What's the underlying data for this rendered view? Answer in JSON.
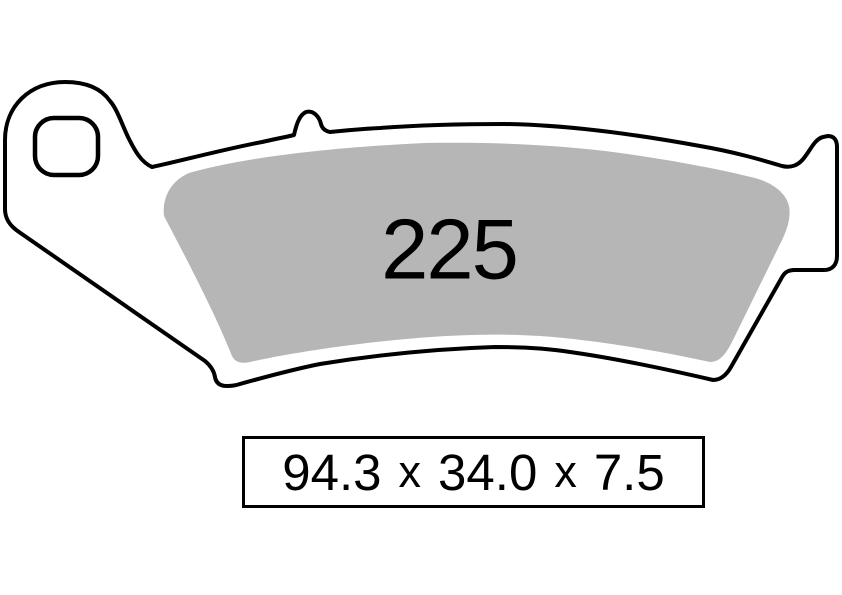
{
  "part_number": "225",
  "dimensions": {
    "parts": [
      "94.3",
      "x",
      "34.0",
      "x",
      "7.5"
    ]
  },
  "colors": {
    "friction_material": "#b6b6b6",
    "outline": "#000000",
    "background": "#ffffff"
  }
}
